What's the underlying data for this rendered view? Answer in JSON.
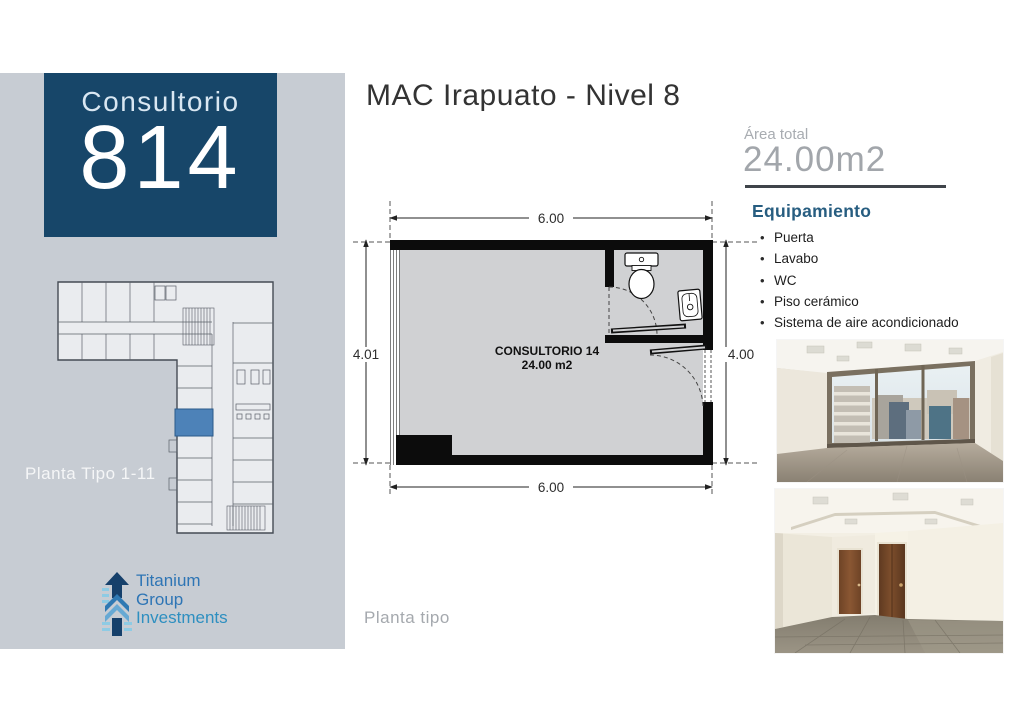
{
  "header": {
    "title": "MAC Irapuato - Nivel 8"
  },
  "sidebar": {
    "unit_card": {
      "label": "Consultorio",
      "number": "814"
    },
    "mini_plan_caption": "Planta Tipo 1-11",
    "logo": {
      "line1": "Titanium",
      "line2": "Group",
      "line3": "Investments"
    }
  },
  "plan": {
    "dim_top": "6.00",
    "dim_bottom": "6.00",
    "dim_left": "4.01",
    "dim_right": "4.00",
    "room_label": "CONSULTORIO 14",
    "room_area": "24.00 m2",
    "caption": "Planta tipo"
  },
  "details": {
    "area_label": "Área total",
    "area_value": "24.00m2",
    "equipment_title": "Equipamiento",
    "equipment_items": [
      "Puerta",
      "Lavabo",
      "WC",
      "Piso cerámico",
      "Sistema de aire acondicionado"
    ]
  },
  "colors": {
    "accent_navy": "#174669",
    "sidebar_gray": "#c7ccd3",
    "equipment_blue": "#275d80",
    "plan_highlight_blue": "#4d82b8",
    "logo_blue": "#2e75b5",
    "logo_light_blue": "#2e8fc0"
  }
}
